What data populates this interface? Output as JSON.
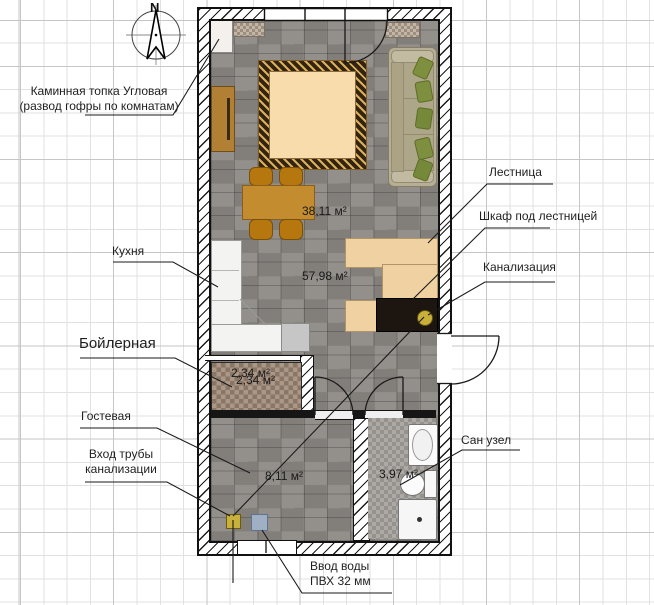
{
  "plan": {
    "compass": "N",
    "labels": {
      "fireplace_1": "Каминная топка Угловая",
      "fireplace_2": "(развод гофры по комнатам)",
      "kitchen": "Кухня",
      "boiler_room": "Бойлерная",
      "guest_room": "Гостевая",
      "sewer_inlet_1": "Вход трубы",
      "sewer_inlet_2": "канализации",
      "stairs": "Лестница",
      "closet_under_stairs": "Шкаф под лестницей",
      "sewer_riser": "Канализация",
      "bathroom": "Сан узел",
      "water_inlet_1": "Ввод воды",
      "water_inlet_2": "ПВХ 32 мм"
    },
    "areas": {
      "living_zone": "38,11 м²",
      "total_floor": "57,98 м²",
      "boiler": "2,34 м²",
      "boiler_duplicate": "2,34 м²",
      "guest": "8,11 м²",
      "bathroom": "3,97 м²"
    },
    "colors": {
      "floor_gray": "#8c8883",
      "stairs_fill": "#f0d2a2",
      "rug_center": "#f8dcab",
      "sofa_body": "#b7af94",
      "pillow_green": "#7e8f40",
      "sewer_marker_gold": "#c7b13a",
      "water_marker_blue": "#9fb0c4",
      "cabinet_dark": "#1c1510"
    }
  }
}
